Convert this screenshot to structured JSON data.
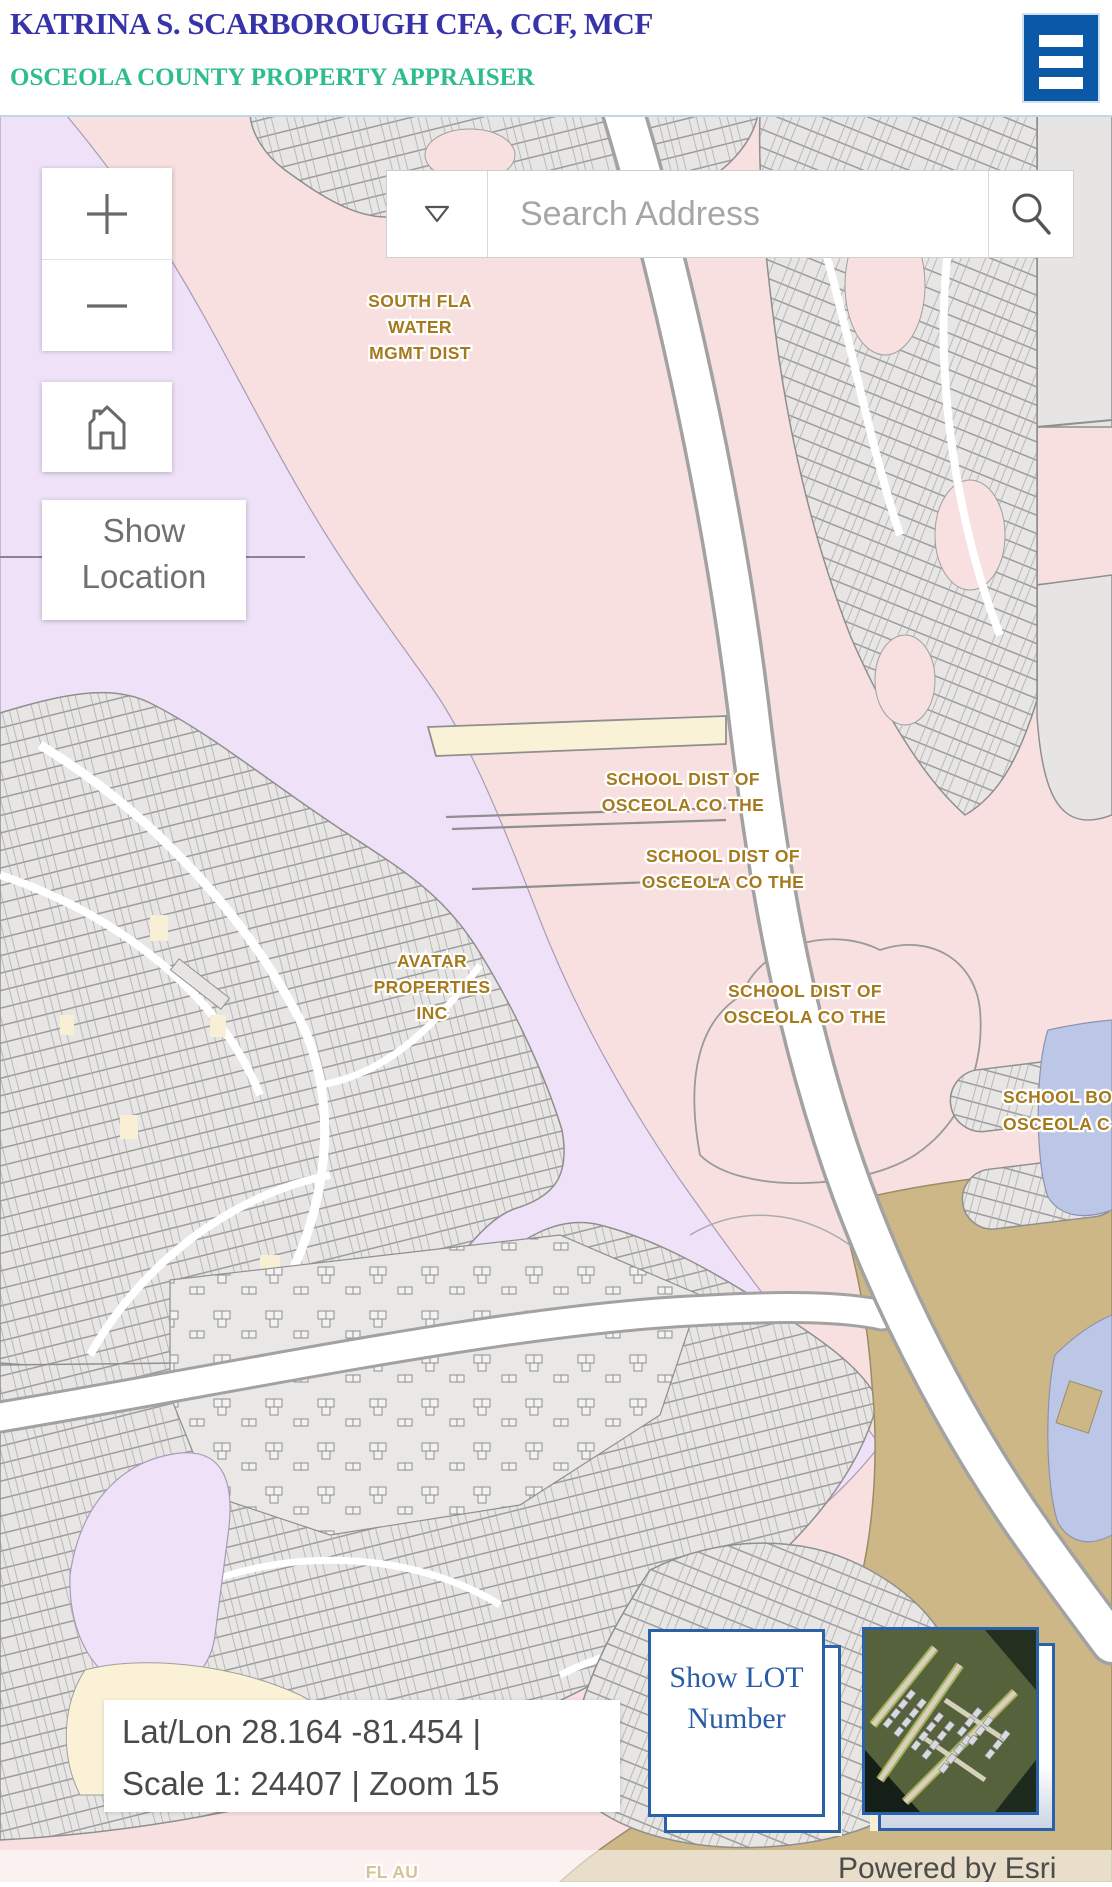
{
  "header": {
    "title": "KATRINA S. SCARBOROUGH CFA, CCF, MCF",
    "subtitle": "OSCEOLA COUNTY PROPERTY APPRAISER",
    "menu_icon": "hamburger-menu-icon"
  },
  "search": {
    "placeholder": "Search Address",
    "dropdown_icon": "chevron-down-icon",
    "search_icon": "magnifier-icon"
  },
  "controls": {
    "zoom_in_icon": "plus-icon",
    "zoom_out_icon": "minus-icon",
    "home_icon": "home-icon",
    "show_location_label": "Show Location",
    "show_lot_label": "Show LOT Number"
  },
  "status": {
    "line1": "Lat/Lon 28.164 -81.454 |",
    "line2": "Scale 1: 24407 | Zoom 15",
    "lat": 28.164,
    "lon": -81.454,
    "scale": "1: 24407",
    "zoom_level": 15
  },
  "map_labels": [
    {
      "lines": [
        "SOUTH FLA",
        "WATER",
        "MGMT DIST"
      ]
    },
    {
      "lines": [
        "SCHOOL DIST OF",
        "OSCEOLA CO THE"
      ]
    },
    {
      "lines": [
        "SCHOOL DIST OF",
        "OSCEOLA CO THE"
      ]
    },
    {
      "lines": [
        "SCHOOL DIST OF",
        "OSCEOLA CO THE"
      ]
    },
    {
      "lines": [
        "SCHOOL BO",
        "OSCEOLA C"
      ]
    },
    {
      "lines": [
        "FL AU"
      ]
    }
  ],
  "attribution": "Powered by Esri",
  "colors": {
    "header_title": "#3634A8",
    "header_subtitle": "#2EBD8F",
    "menu_blue": "#0B59A6",
    "card_border_blue": "#2A61AB",
    "show_lot_text": "#2A5DA8",
    "label_gold": "#A5791C",
    "map_pink": "#F8E0E1",
    "map_lavender": "#EFE2F8",
    "map_gray": "#E7E6E4",
    "map_tan": "#CDB787",
    "map_water": "#BCC6E6",
    "road_white": "#FFFFFF"
  }
}
